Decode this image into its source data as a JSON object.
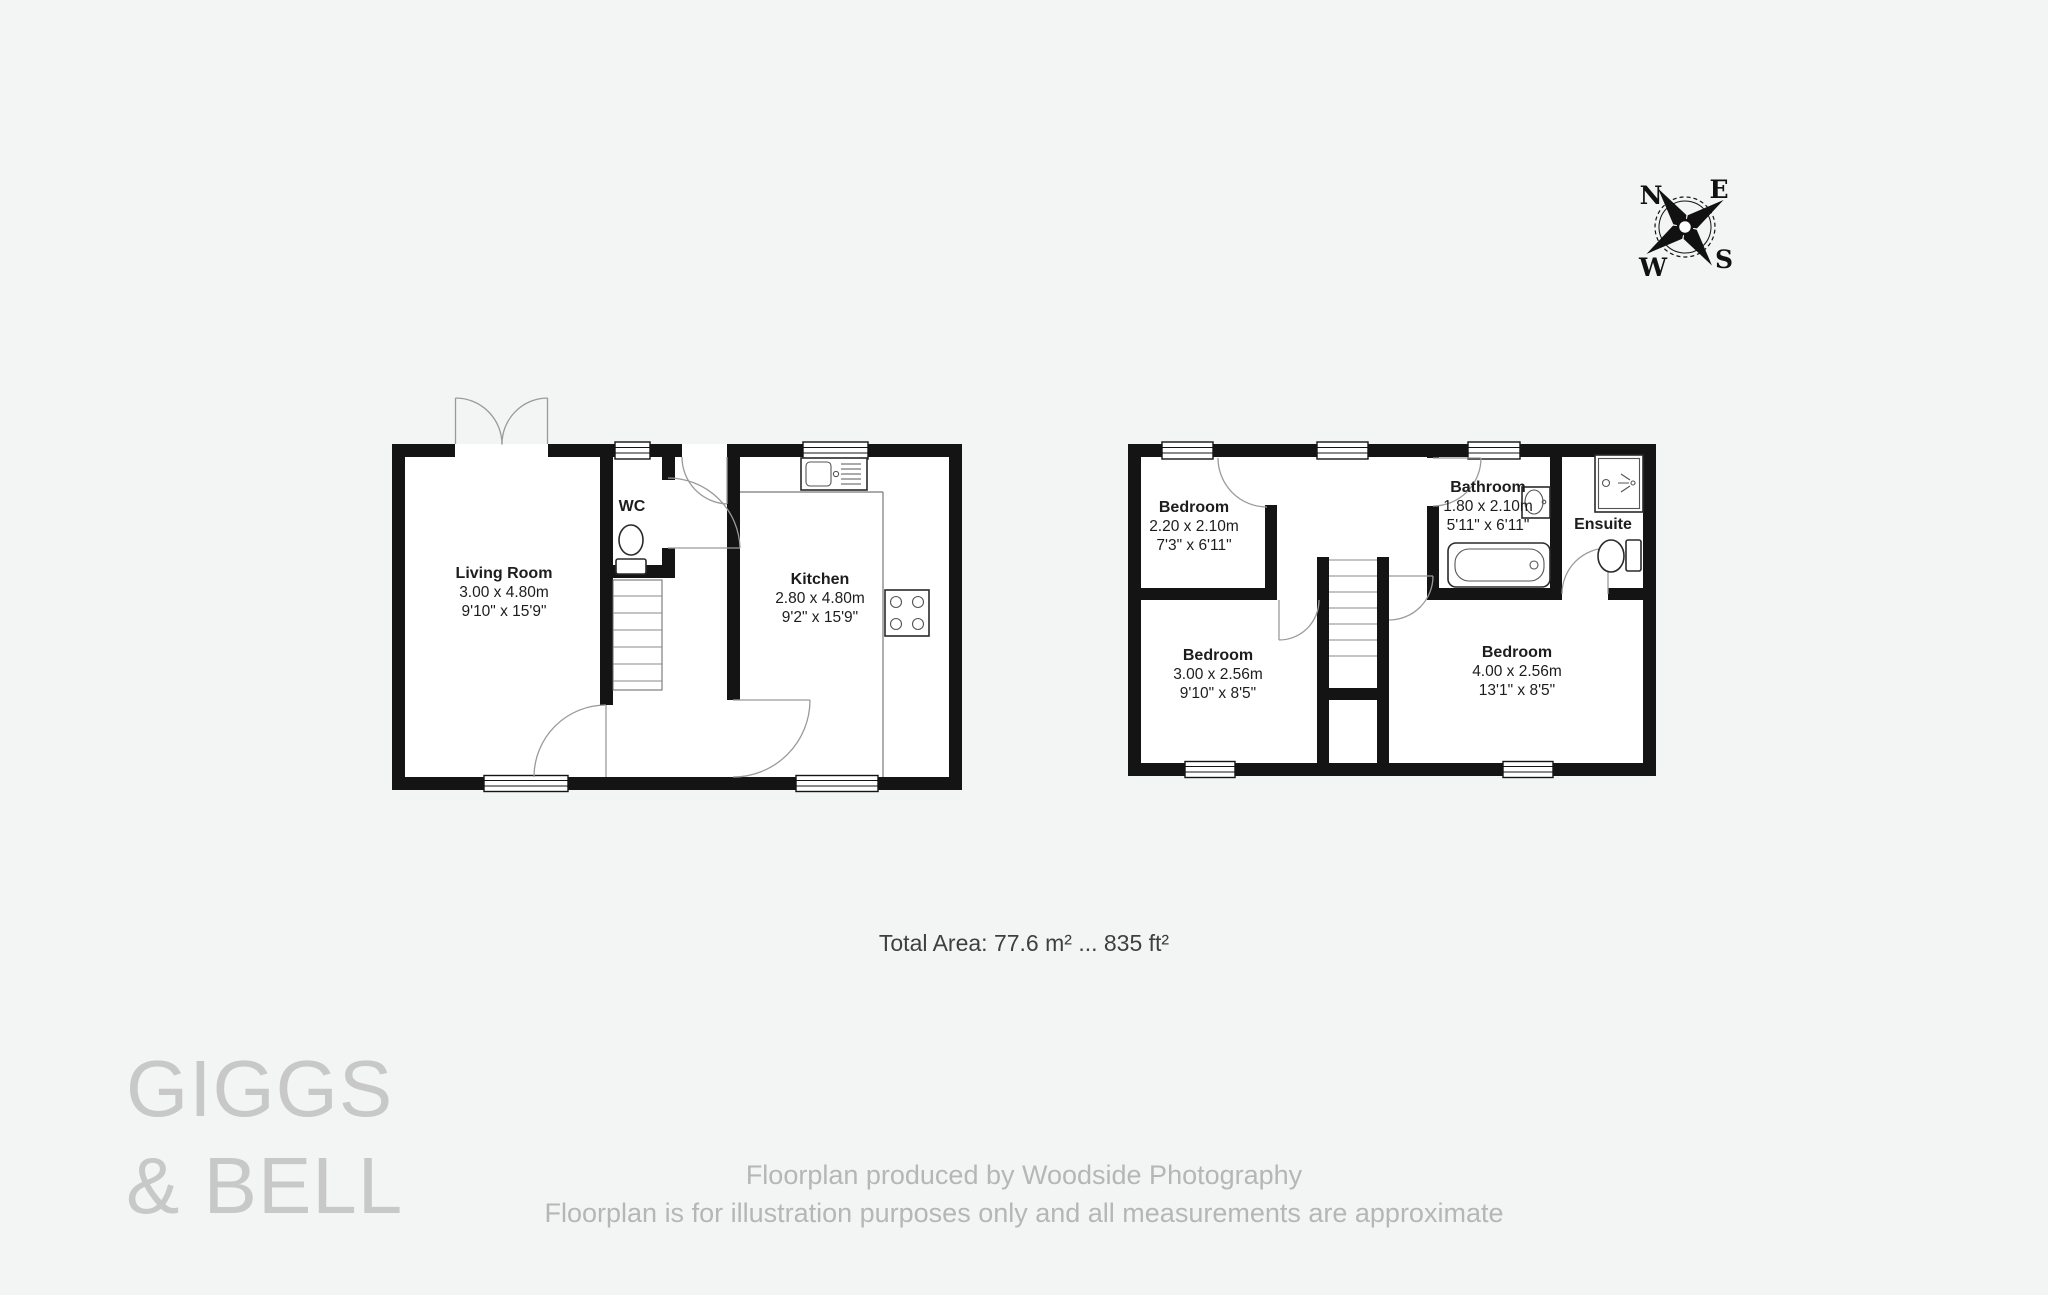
{
  "watermark": {
    "line1": "GIGGS",
    "line2": "& BELL"
  },
  "compass": {
    "n": "N",
    "e": "E",
    "s": "S",
    "w": "W"
  },
  "summary": {
    "total_area": "Total Area: 77.6 m² ... 835 ft²"
  },
  "footer": {
    "line1": "Floorplan produced by Woodside Photography",
    "line2": "Floorplan is for illustration purposes only and all measurements are approximate"
  },
  "ground_floor": {
    "living_room": {
      "name": "Living Room",
      "metric": "3.00 x 4.80m",
      "imperial": "9'10\" x 15'9\""
    },
    "wc": {
      "name": "WC"
    },
    "kitchen": {
      "name": "Kitchen",
      "metric": "2.80 x 4.80m",
      "imperial": "9'2\" x 15'9\""
    }
  },
  "first_floor": {
    "bedroom_front": {
      "name": "Bedroom",
      "metric": "2.20 x 2.10m",
      "imperial": "7'3\" x 6'11\""
    },
    "bathroom": {
      "name": "Bathroom",
      "metric": "1.80 x 2.10m",
      "imperial": "5'11\" x 6'11\""
    },
    "ensuite": {
      "name": "Ensuite"
    },
    "bedroom_left": {
      "name": "Bedroom",
      "metric": "3.00 x 2.56m",
      "imperial": "9'10\" x 8'5\""
    },
    "bedroom_right": {
      "name": "Bedroom",
      "metric": "4.00 x 2.56m",
      "imperial": "13'1\" x 8'5\""
    }
  }
}
